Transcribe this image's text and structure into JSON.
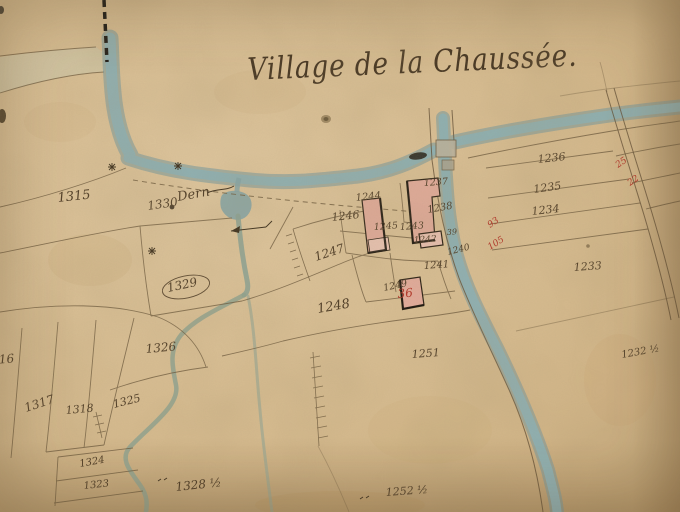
{
  "map": {
    "title": "Village de la Chaussée.",
    "path_label": "Dern",
    "parcels": {
      "1315": "1315",
      "1330": "1330",
      "1329": "1329",
      "1316": "1316",
      "1326": "1326",
      "1317": "1317",
      "1318": "1318",
      "1325": "1325",
      "1324": "1324",
      "1323": "1323",
      "1328h": "1328 ½",
      "1252h": "1252 ½",
      "1251": "1251",
      "1248": "1248",
      "1247": "1247",
      "1249": "1249",
      "1246": "1246",
      "1244": "1244",
      "1245": "1245",
      "1243": "1243",
      "1237": "1237",
      "1238": "1238",
      "1242": "1242",
      "39": "39",
      "1240": "1240",
      "1241": "1241",
      "1236": "1236",
      "1235": "1235",
      "1234": "1234",
      "1233": "1233",
      "1232h": "1232 ½"
    },
    "red_annotations": {
      "36": "36",
      "93": "93",
      "105": "105",
      "25": "25",
      "22": "22"
    },
    "colors": {
      "paper": "#d8bf96",
      "river": "#87a8ab",
      "river_edge": "#74989e",
      "stream": "#8fa595",
      "building": "#e2ab9b",
      "ink": "#4e3c26",
      "red": "#b23226",
      "road_band": "#cfc6a6"
    }
  }
}
